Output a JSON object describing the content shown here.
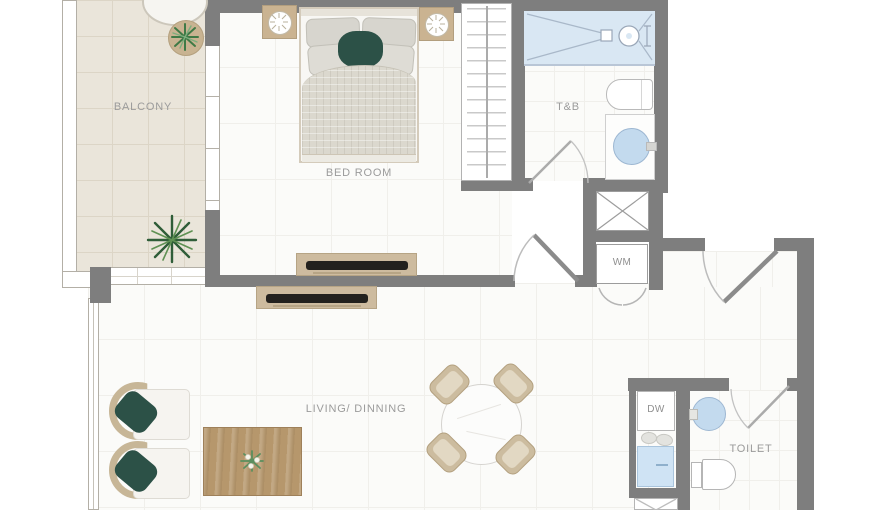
{
  "labels": {
    "balcony": "BALCONY",
    "bedroom": "BED ROOM",
    "bathroom": "T&B",
    "living": "LIVING/ DINNING",
    "toilet": "TOILET",
    "washing_machine": "WM",
    "dishwasher": "DW"
  },
  "colors": {
    "wall": "#7e7e7e",
    "balcony_floor": "#eae5da",
    "room_floor": "#fbfbf9",
    "shower_blue": "#d9e7f3",
    "sink_blue": "#c3daee",
    "wood_light": "#cdbb9f",
    "wood_table": "#b6976c",
    "green_cushion": "#2c5147",
    "plant_green": "#3f7a46",
    "label_text": "#9b9b9b"
  }
}
